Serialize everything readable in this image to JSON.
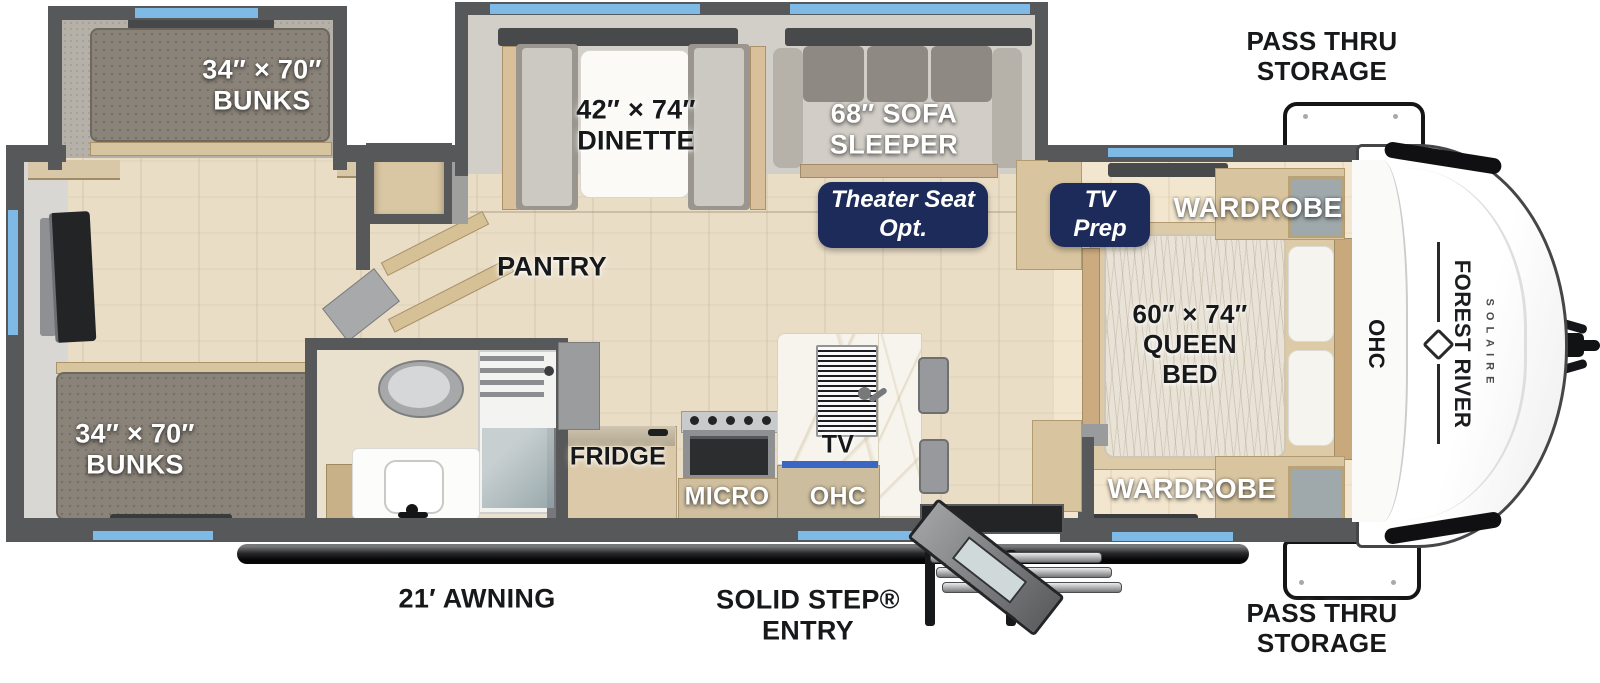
{
  "labels": {
    "pass_thru_top": {
      "line1": "PASS THRU",
      "line2": "STORAGE"
    },
    "pass_thru_bottom": {
      "line1": "PASS THRU",
      "line2": "STORAGE"
    },
    "bunks_top": {
      "line1": "34″ × 70″",
      "line2": "BUNKS"
    },
    "bunks_bottom": {
      "line1": "34″ × 70″",
      "line2": "BUNKS"
    },
    "dinette": {
      "line1": "42″ × 74″",
      "line2": "DINETTE"
    },
    "sofa_sleeper": {
      "line1": "68″ SOFA",
      "line2": "SLEEPER"
    },
    "wardrobe_top": "WARDROBE",
    "wardrobe_bottom": "WARDROBE",
    "queen_bed": {
      "line1": "60″ × 74″",
      "line2": "QUEEN",
      "line3": "BED"
    },
    "ohc_bedroom": "OHC",
    "pantry": "PANTRY",
    "fridge": "FRIDGE",
    "micro": "MICRO",
    "tv": "TV",
    "ohc_kitchen": "OHC",
    "awning": "21′ AWNING",
    "entry": {
      "line1": "SOLID STEP®",
      "line2": "ENTRY"
    }
  },
  "badges": {
    "theater_seat": {
      "line1": "Theater Seat",
      "line2": "Opt."
    },
    "tv_prep": {
      "line1": "TV",
      "line2": "Prep"
    }
  },
  "brand": {
    "manufacturer": "FOREST RIVER",
    "model": "SOLAIRE"
  },
  "colors": {
    "wall": "#57585a",
    "window_blue": "#7fb9e6",
    "badge_navy": "#1d2b5a",
    "cabinet_wood": "#d8c5a0",
    "floor_wood": "#e9ddc6",
    "awning_black": "#0a0a0b",
    "kitchen_window_blue": "#3a66c4"
  }
}
